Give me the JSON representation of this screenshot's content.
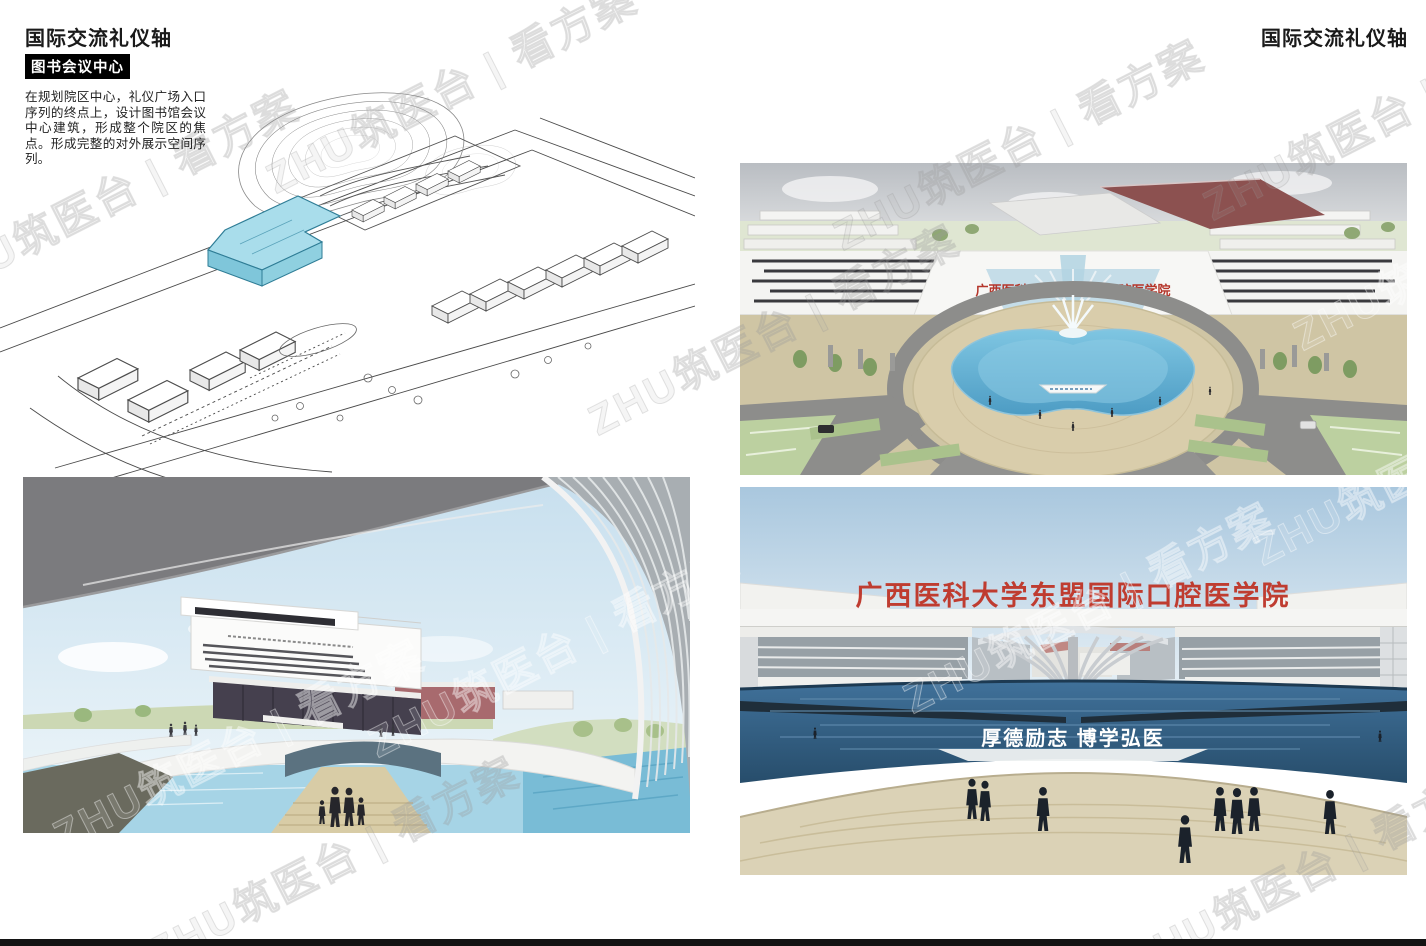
{
  "header": {
    "title_left": "国际交流礼仪轴",
    "title_right": "国际交流礼仪轴",
    "section_label": "图书会议中心",
    "description": "在规划院区中心，礼仪广场入口序列的终点上，设计图书馆会议中心建筑，形成整个院区的焦点。形成完整的对外展示空间序列。"
  },
  "site_plan": {
    "highlight_color": "#a9ddeb"
  },
  "renderings": {
    "aerial_plaza": {
      "banner_text": "广西医科大学东盟国际口腔医学院",
      "banner_color": "#b5362b"
    },
    "gate_view": {
      "banner_text": "广西医科大学东盟国际口腔医学院",
      "banner_color": "#bf3c30",
      "motto_text": "厚德励志 博学弘医",
      "motto_color": "#ffffff"
    }
  },
  "watermark": {
    "text": "ZHU筑医台 | 看方案"
  },
  "footer": {
    "bar_color": "#141414"
  }
}
